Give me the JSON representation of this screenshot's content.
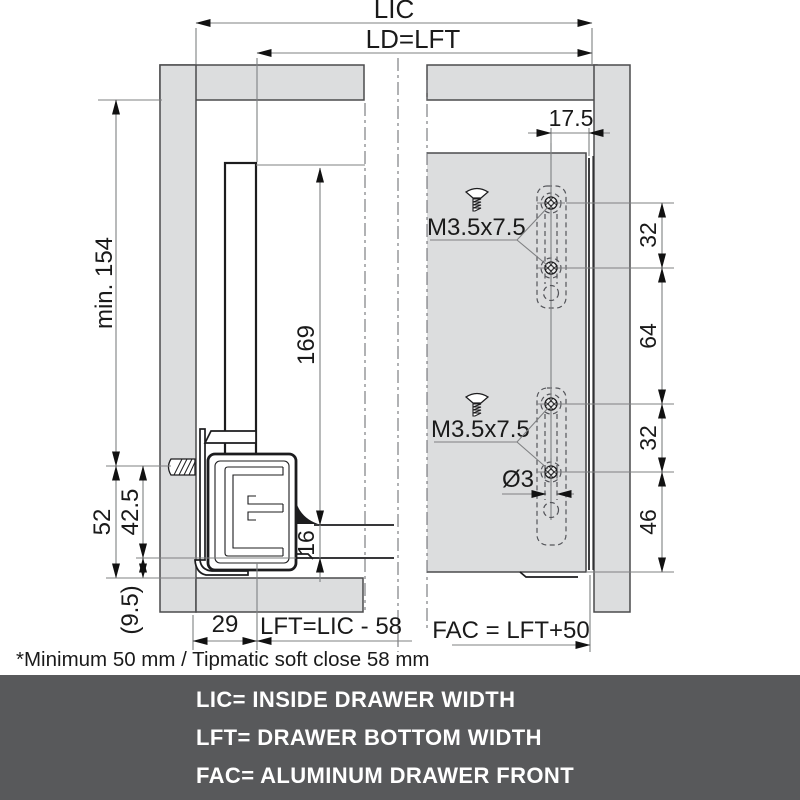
{
  "diagram": {
    "overall_dims": {
      "lic": "LIC",
      "ld_lft": "LD=LFT"
    },
    "left_view": {
      "min_height": "min. 154",
      "side_height": "169",
      "dim_52": "52",
      "dim_42_5": "42.5",
      "dim_9_5": "(9.5)",
      "dim_16": "16",
      "dim_29": "29",
      "lft_formula": "LFT=LIC - 58"
    },
    "right_view": {
      "dim_17_5": "17.5",
      "screw_spec_upper": "M3.5x7.5",
      "screw_spec_lower": "M3.5x7.5",
      "dim_32_upper": "32",
      "dim_64": "64",
      "dim_32_lower": "32",
      "dim_46": "46",
      "hole_diameter": "Ø3",
      "fac_formula": "FAC = LFT+50"
    },
    "footnote": "*Minimum 50 mm / Tipmatic soft close 58 mm",
    "icons": {
      "screw_side": "mounting-screw-side-view",
      "screw_front": "countersunk-screw-front-view",
      "mounting_hole": "cross-mounting-hole",
      "pilot_hole": "pilot-hole-dashed"
    }
  },
  "footer": {
    "lines": [
      "LIC= INSIDE DRAWER WIDTH",
      "LFT= DRAWER BOTTOM WIDTH",
      "FAC= ALUMINUM DRAWER FRONT"
    ]
  },
  "colors": {
    "panel_fill": "#dcddde",
    "outline": "#1c1c1e",
    "dimension_line": "#7f8082",
    "centerline": "#63646a",
    "footer_bg": "#58595b",
    "footer_text": "#ffffff"
  }
}
